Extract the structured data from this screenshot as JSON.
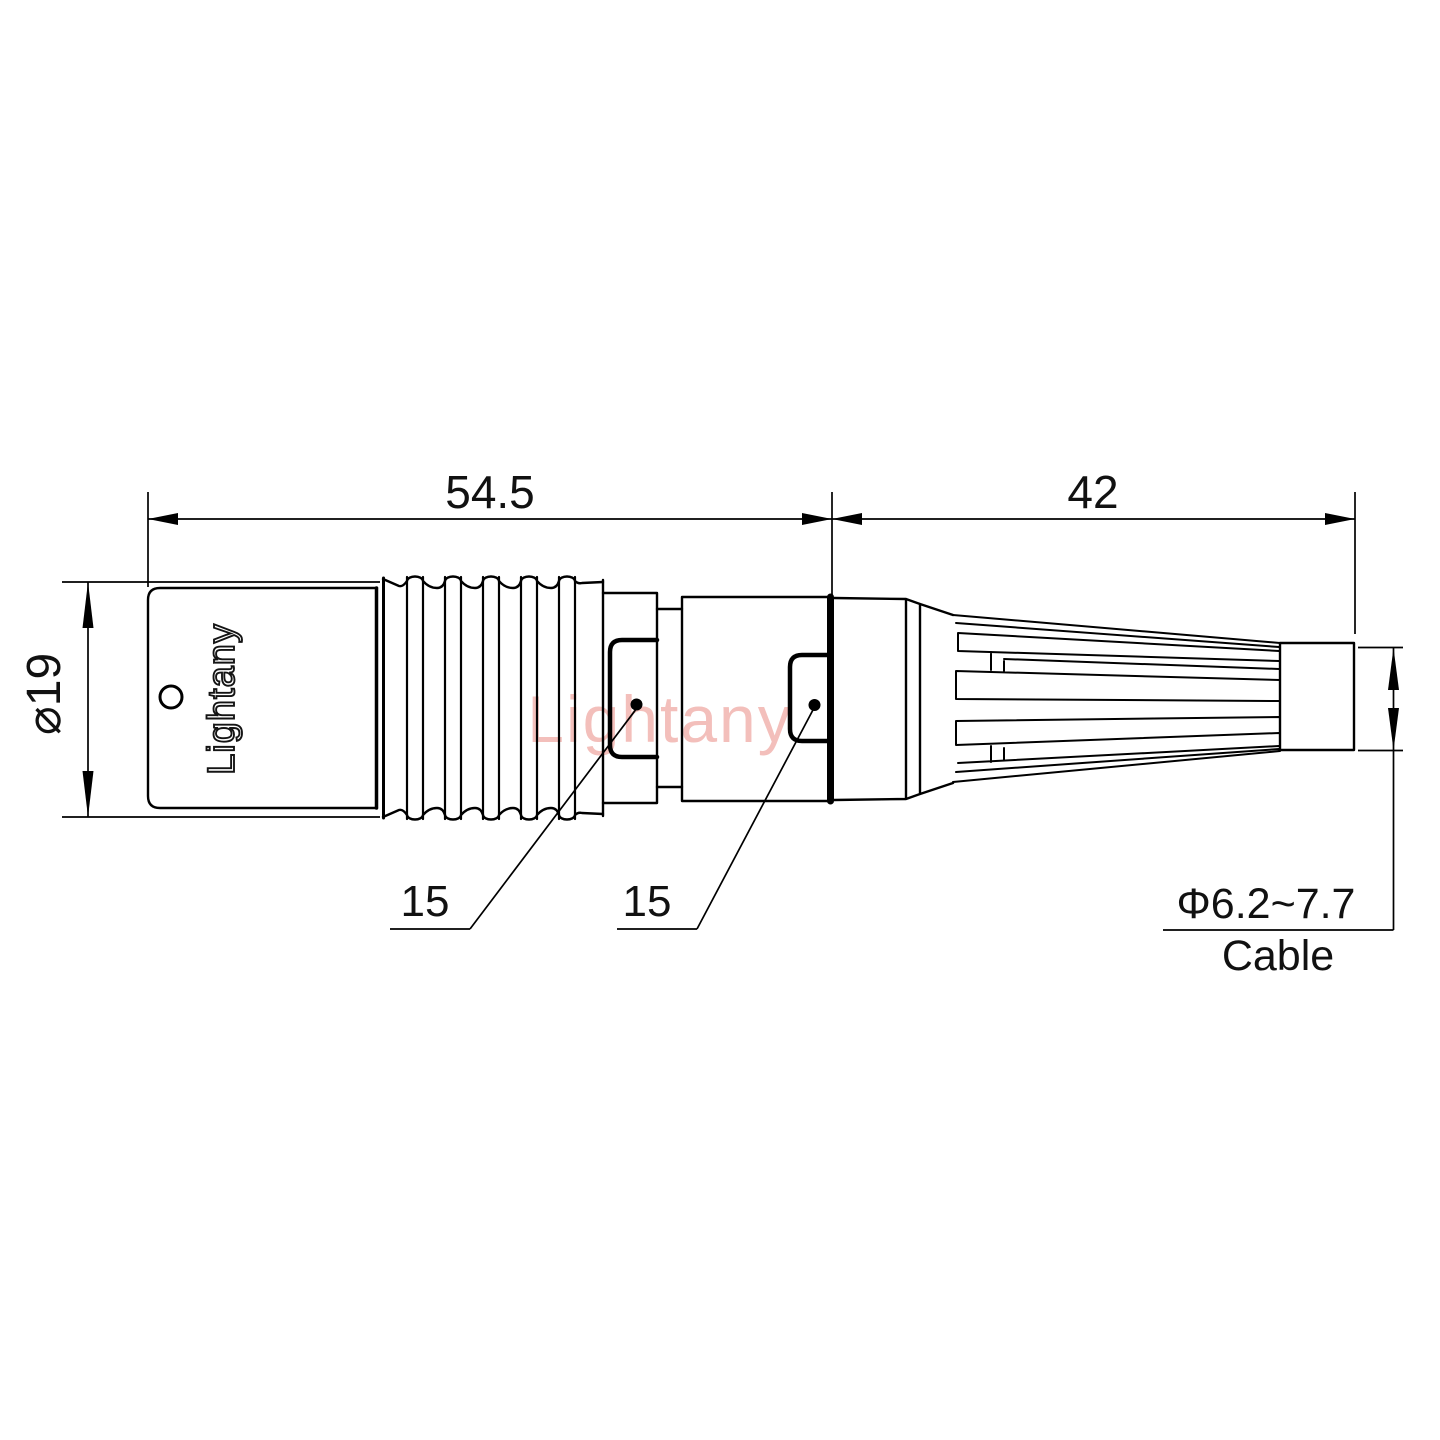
{
  "drawing": {
    "dimensions": {
      "front_length": "54.5",
      "rear_length": "42",
      "outer_diameter": "⌀19",
      "front_callout": "15",
      "rear_callout": "15",
      "cable_range": "Φ6.2~7.7",
      "cable_label": "Cable"
    },
    "branding": {
      "body_marking": "Lightany",
      "watermark": "Lightany"
    },
    "colors": {
      "line": "#000000",
      "watermark": "#f1b4b0"
    }
  }
}
